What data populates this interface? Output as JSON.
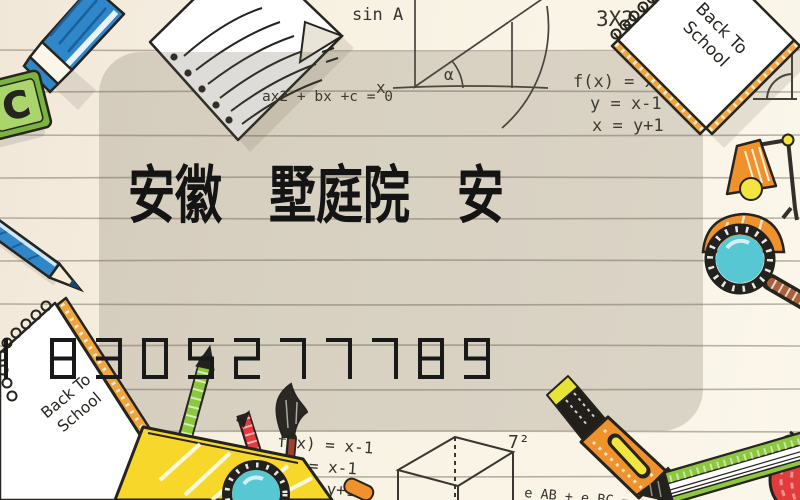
{
  "title": {
    "text": "安徽　墅庭院　安"
  },
  "phone": {
    "number": "18305277789"
  },
  "doodles": {
    "sin_label": "sin A",
    "eq_3x2": "3X2",
    "eq_quadratic": "ax2 + bx +c = 0",
    "x_label": "x",
    "alpha_label": "α",
    "tile_letter": "C",
    "formulas_right": [
      "f(x) = x-1",
      "y = x-1",
      "x = y+1"
    ],
    "formulas_bottom": [
      "f(x) = x-1",
      "y = x-1",
      "x = y+1"
    ],
    "seven_squared": "7²",
    "eq_edges": "e AB + e BC = e AB",
    "notebook_line1": "Back To",
    "notebook_line2": "School"
  },
  "palette": {
    "paper": "#f8f2e3",
    "card_tint": "rgba(100,90,70,0.21)",
    "ink": "#26241f",
    "digit_ink": "#191919",
    "blue": "#2f86c8",
    "green": "#8dc63f",
    "green_dark": "#7ab33e",
    "yellow": "#f7d82a",
    "orange": "#f0922b",
    "orange_band": "#f2a53c",
    "red": "#e23b3b",
    "teal": "#57c7d4",
    "brown": "#a8613a",
    "bulb_yellow": "#f3e43f"
  }
}
